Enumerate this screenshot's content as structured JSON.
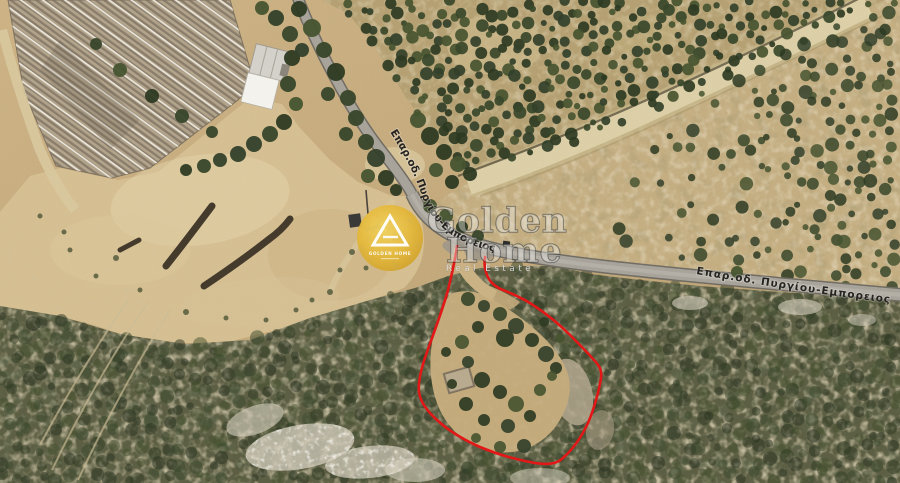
{
  "map": {
    "description": "Satellite view of a land plot outlined in red beside a provincial road",
    "road_labels": {
      "north_road": "Επαρ.οδ. Πυργίου-Εμπορειος",
      "east_road": "Επαρ.οδ. Πυργίου-Εμπορειος"
    },
    "parcel_outline_color": "#e41717"
  },
  "watermark": {
    "brand_line1": "Golden",
    "brand_line2": "Home",
    "tagline": "Real Estate",
    "logo_caption": "GOLDEN HOME",
    "gold_color": "#e2b23a"
  }
}
